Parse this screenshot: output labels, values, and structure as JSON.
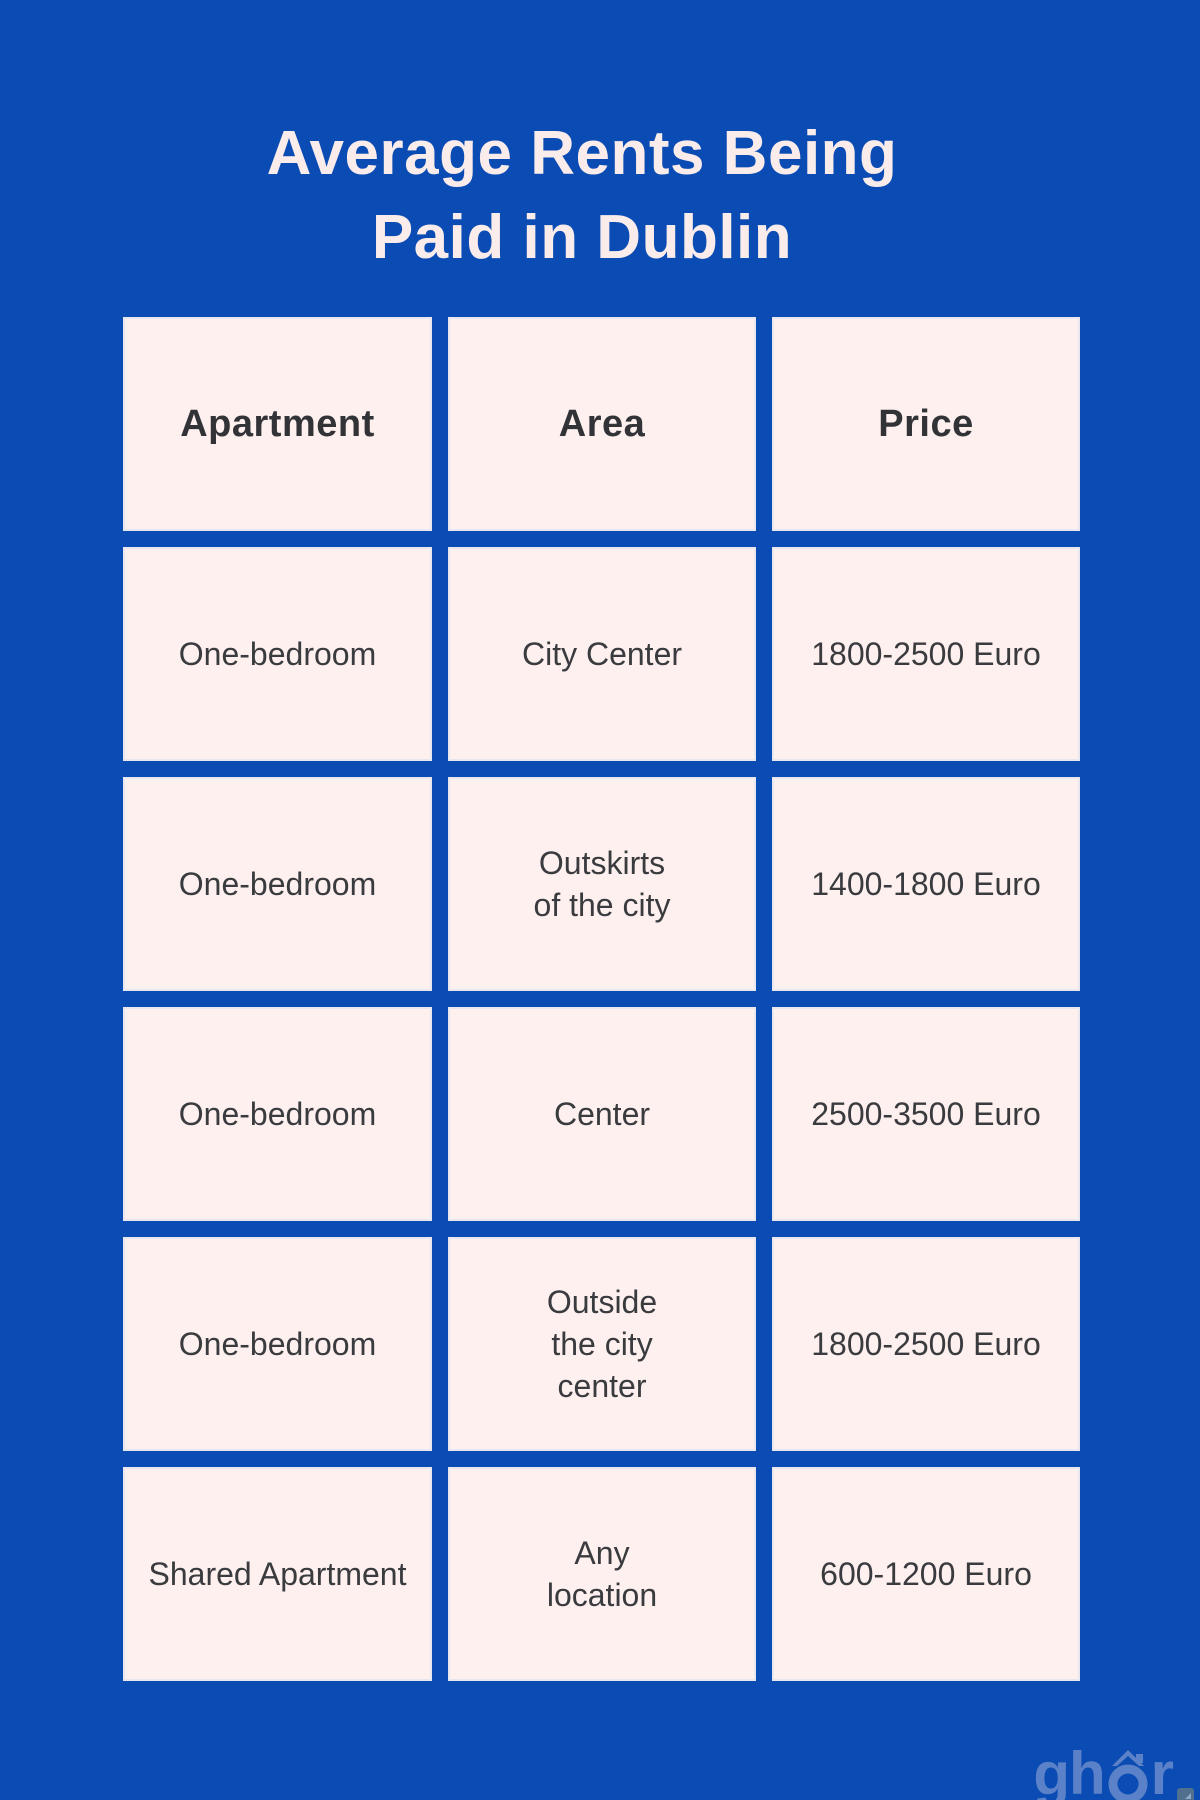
{
  "page": {
    "background_color": "#0a4cb3",
    "title_line1": "Average Rents Being",
    "title_line2": "Paid in Dublin",
    "title_color": "#faeceb"
  },
  "chart_data": {
    "type": "table",
    "title": "Average Rents Being Paid in Dublin",
    "columns": [
      "Apartment",
      "Area",
      "Price"
    ],
    "rows": [
      [
        "One-bedroom",
        "City Center",
        "1800-2500 Euro"
      ],
      [
        "One-bedroom",
        "Outskirts of the city",
        "1400-1800 Euro"
      ],
      [
        "One-bedroom",
        "Center",
        "2500-3500 Euro"
      ],
      [
        "One-bedroom",
        "Outside the city center",
        "1800-2500 Euro"
      ],
      [
        "Shared Apartment",
        "Any location",
        "600-1200 Euro"
      ]
    ],
    "layout": {
      "cell_background": "#fdf0ee",
      "cell_text_color": "#3a3b3f",
      "grid_gap_color": "#0a4cb3"
    }
  },
  "table": {
    "headers": [
      "Apartment",
      "Area",
      "Price"
    ],
    "rows": [
      {
        "apartment": "One-bedroom",
        "area": "City Center",
        "price": "1800-2500 Euro"
      },
      {
        "apartment": "One-bedroom",
        "area": "Outskirts\nof the city",
        "price": "1400-1800 Euro"
      },
      {
        "apartment": "One-bedroom",
        "area": "Center",
        "price": "2500-3500 Euro"
      },
      {
        "apartment": "One-bedroom",
        "area": "Outside\nthe city\ncenter",
        "price": "1800-2500 Euro"
      },
      {
        "apartment": "Shared Apartment",
        "area": "Any\nlocation",
        "price": "600-1200 Euro"
      }
    ]
  },
  "watermark": {
    "part_gh": "gh",
    "part_r": "r",
    "color": "#5b82c8"
  }
}
